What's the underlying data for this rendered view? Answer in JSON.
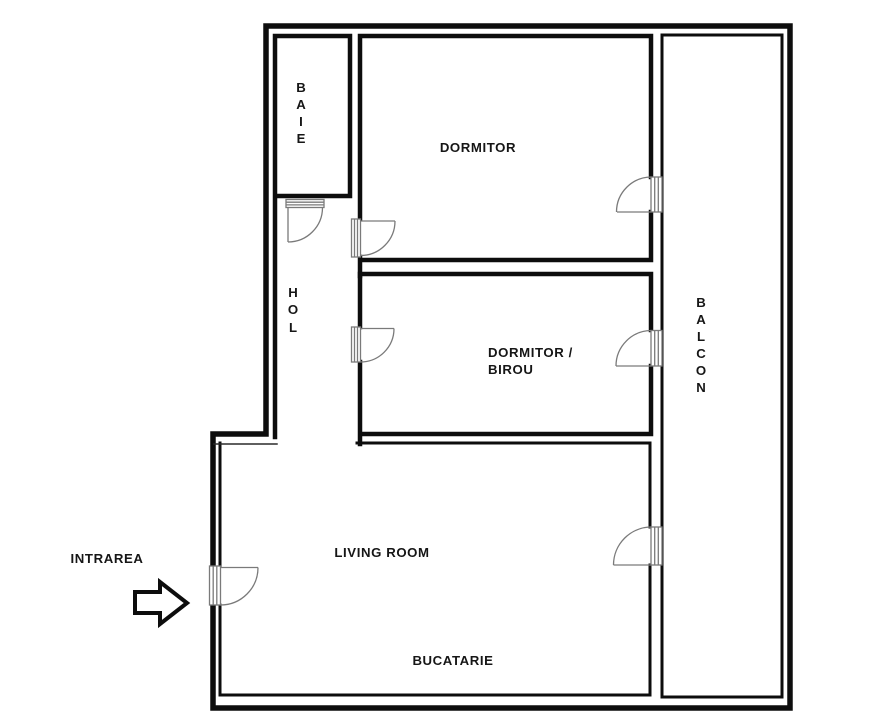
{
  "plan": {
    "title": "Apartment floor plan",
    "language": "Romanian"
  },
  "rooms": {
    "baie": {
      "label": "BAIE",
      "letters": [
        "B",
        "A",
        "I",
        "E"
      ],
      "orientation": "vertical"
    },
    "dormitor": {
      "label": "DORMITOR",
      "orientation": "horizontal"
    },
    "hol": {
      "label": "HOL",
      "letters": [
        "H",
        "O",
        "L"
      ],
      "orientation": "vertical"
    },
    "dormitor_birou": {
      "label": "DORMITOR / BIROU",
      "line1": "DORMITOR /",
      "line2": "BIROU",
      "orientation": "horizontal"
    },
    "balcon": {
      "label": "BALCON",
      "letters": [
        "B",
        "A",
        "L",
        "C",
        "O",
        "N"
      ],
      "orientation": "vertical"
    },
    "living": {
      "label": "LIVING ROOM",
      "orientation": "horizontal"
    },
    "bucatarie": {
      "label": "BUCATARIE",
      "orientation": "horizontal"
    }
  },
  "entrance": {
    "label": "INTRAREA",
    "arrow_icon": "right-arrow"
  },
  "doors": [
    {
      "name": "door-baie-hol",
      "between": [
        "BAIE",
        "HOL"
      ]
    },
    {
      "name": "door-hol-dormitor",
      "between": [
        "HOL",
        "DORMITOR"
      ]
    },
    {
      "name": "door-hol-birou",
      "between": [
        "HOL",
        "DORMITOR / BIROU"
      ]
    },
    {
      "name": "door-dormitor-balcon",
      "between": [
        "DORMITOR",
        "BALCON"
      ]
    },
    {
      "name": "door-birou-balcon",
      "between": [
        "DORMITOR / BIROU",
        "BALCON"
      ]
    },
    {
      "name": "door-living-balcon",
      "between": [
        "LIVING ROOM",
        "BALCON"
      ]
    },
    {
      "name": "door-entrance",
      "between": [
        "EXTERIOR",
        "LIVING ROOM"
      ]
    }
  ],
  "colors": {
    "background": "#ffffff",
    "wall": "#0d0d0d",
    "door_symbol": "#7a7a7a",
    "text": "#161616"
  }
}
